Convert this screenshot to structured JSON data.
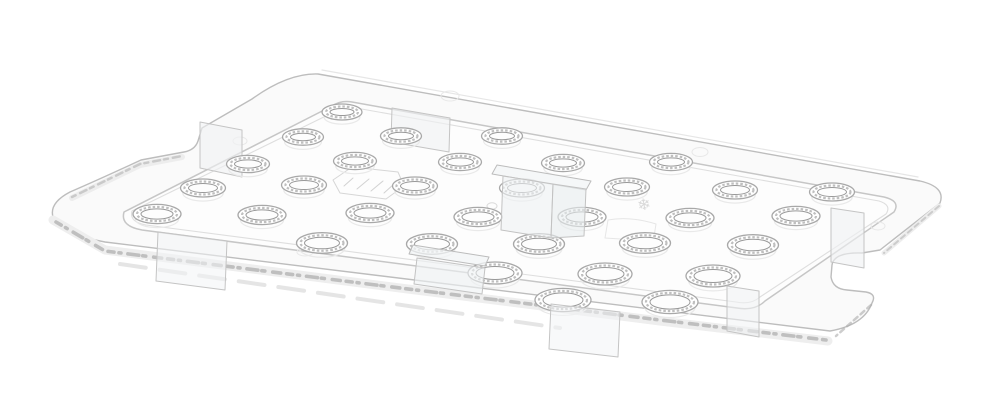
{
  "meta": {
    "background_color": "#ffffff",
    "palette": {
      "plate_fill": "#fafafa",
      "rim_field_fill": "#fdfdfd",
      "outline": "#bdbdbd",
      "rim_line": "#c6c6c6",
      "rim_line_light": "#dedede",
      "hole_ring": "#a8a8a8",
      "hole_texture": "#bfbfbf",
      "hole_inner": "#989898",
      "ghost": "#e9e9e9",
      "sparkle": "#8f8f8f",
      "tab_fill": "rgba(240,242,244,0.6)",
      "tab_stroke": "#bfbfbf"
    }
  },
  "scene": {
    "canvas": {
      "w": 1000,
      "h": 406,
      "bg": "#ffffff"
    },
    "layers": [
      {
        "name": "plate-far-edge-underside",
        "type": "polyline",
        "pts": [
          [
            322,
            70
          ],
          [
            918,
            177
          ]
        ],
        "stroke": "#e6e6e6",
        "w": 1.2
      },
      {
        "name": "plate-body",
        "type": "path",
        "d": "M 318,74 L 920,181 Q 946,187 940,203 L 880,250 L 862,253 Q 834,252 832,265 L 831,277 Q 833,289 847,290 L 866,292 Q 877,294 872,303 Q 864,325 830,331 L 105,242 Q 58,233 53,217 Q 49,203 70,192 Q 100,179 141,160 L 184,152 Q 195,150 198,141 L 202,128 L 252,99 Q 288,73 318,74 Z",
        "fill": "#fafafa",
        "stroke": "#bdbdbd",
        "w": 1.4
      },
      {
        "name": "edge-band-front",
        "type": "polyline",
        "pts": [
          [
            53,
            220
          ],
          [
            105,
            250
          ],
          [
            400,
            288
          ],
          [
            660,
            321
          ],
          [
            828,
            341
          ]
        ],
        "stroke": "#eeeeee",
        "w": 9
      },
      {
        "name": "edge-sparkle-front",
        "type": "polyline",
        "pts": [
          [
            56,
            222
          ],
          [
            105,
            251
          ],
          [
            400,
            288
          ],
          [
            660,
            320
          ],
          [
            826,
            340
          ]
        ],
        "stroke": "#8f8f8f",
        "w": 3.6,
        "dash": "6 5 2 7 11 4 3 8 8 6",
        "opacity": 0.5
      },
      {
        "name": "edge-ghost-line",
        "type": "polyline",
        "pts": [
          [
            120,
            264
          ],
          [
            560,
            328
          ]
        ],
        "stroke": "#e2e2e2",
        "w": 4,
        "dash": "26 14",
        "opacity": 0.9
      },
      {
        "name": "edge-band-left",
        "type": "polyline",
        "pts": [
          [
            72,
            198
          ],
          [
            140,
            165
          ],
          [
            182,
            157
          ]
        ],
        "stroke": "#ededed",
        "w": 6
      },
      {
        "name": "edge-sparkle-left",
        "type": "polyline",
        "pts": [
          [
            72,
            197
          ],
          [
            140,
            164
          ],
          [
            182,
            156
          ]
        ],
        "stroke": "#a8a8a8",
        "w": 2.5,
        "dash": "4 5 7 4",
        "opacity": 0.5
      },
      {
        "name": "edge-band-right",
        "type": "polyline",
        "pts": [
          [
            939,
            206
          ],
          [
            884,
            253
          ]
        ],
        "stroke": "#ededed",
        "w": 5
      },
      {
        "name": "edge-sparkle-right",
        "type": "polyline",
        "pts": [
          [
            939,
            206
          ],
          [
            884,
            253
          ]
        ],
        "stroke": "#ababab",
        "w": 2,
        "dash": "5 4",
        "opacity": 0.5
      },
      {
        "name": "edge-sparkle-corner",
        "type": "polyline",
        "pts": [
          [
            871,
            305
          ],
          [
            836,
            336
          ]
        ],
        "stroke": "#ababab",
        "w": 2.5,
        "dash": "5 4",
        "opacity": 0.6
      },
      {
        "name": "rim-outer",
        "type": "path",
        "d": "M 352,102 L 884,197 Q 901,201 894,212 L 765,301 Q 755,311 737,308 L 142,230 Q 120,226 124,212 L 332,106 Q 341,100 352,102 Z",
        "fill": "#fdfdfd",
        "stroke": "#c6c6c6",
        "w": 1.5
      },
      {
        "name": "rim-inner",
        "type": "path",
        "d": "M 356,108 L 879,201 Q 892,205 886,214 L 760,297 Q 751,305 736,302 L 146,225 Q 129,222 132,211 L 334,112 Q 342,106 356,108 Z",
        "fill": "none",
        "stroke": "#dedede",
        "w": 1.1
      },
      {
        "name": "flange-bump",
        "type": "ellipse",
        "cx": 240,
        "cy": 141,
        "rx": 7,
        "ry": 4,
        "stroke": "#e8e8e8",
        "w": 1,
        "fill": "none"
      },
      {
        "name": "flange-bump",
        "type": "ellipse",
        "cx": 450,
        "cy": 96,
        "rx": 9,
        "ry": 5,
        "stroke": "#e8e8e8",
        "w": 1,
        "fill": "none"
      },
      {
        "name": "flange-bump",
        "type": "ellipse",
        "cx": 700,
        "cy": 152,
        "rx": 8,
        "ry": 4.5,
        "stroke": "#e8e8e8",
        "w": 1,
        "fill": "none"
      },
      {
        "name": "flange-bump",
        "type": "ellipse",
        "cx": 878,
        "cy": 226,
        "rx": 7,
        "ry": 4,
        "stroke": "#e8e8e8",
        "w": 1,
        "fill": "none"
      },
      {
        "name": "flange-bump",
        "type": "ellipse",
        "cx": 305,
        "cy": 252,
        "rx": 8,
        "ry": 4,
        "stroke": "#e8e8e8",
        "w": 1,
        "fill": "none"
      },
      {
        "name": "embossed-marking",
        "type": "path",
        "d": "M 333,180 L 352,167 L 398,172 L 404,186 L 386,199 L 340,193 Z",
        "fill": "none",
        "stroke": "#d6d6d6",
        "w": 1
      },
      {
        "name": "embossed-marking-lines",
        "type": "multiline",
        "segs": [
          [
            [
              344,
              186
            ],
            [
              353,
              178
            ]
          ],
          [
            [
              357,
              189
            ],
            [
              369,
              179
            ]
          ],
          [
            [
              371,
              191
            ],
            [
              383,
              181
            ]
          ],
          [
            [
              384,
              193
            ],
            [
              394,
              184
            ]
          ]
        ],
        "stroke": "#d2d2d2",
        "w": 1
      },
      {
        "name": "snowflake-embossing",
        "type": "glyph",
        "x": 645,
        "y": 210,
        "str": "❄",
        "size": 16,
        "fill": "#d9d9d9",
        "rotate": -10
      },
      {
        "name": "embossed-patch",
        "type": "path",
        "d": "M 608,220 Q 630,216 656,224 L 653,243 Q 630,239 605,238 Z",
        "fill": "none",
        "stroke": "#e6e6e6",
        "w": 1
      },
      {
        "name": "embossed-dot",
        "type": "ellipse",
        "cx": 492,
        "cy": 206,
        "rx": 5,
        "ry": 3.2,
        "stroke": "#dadada",
        "w": 1,
        "fill": "none"
      },
      {
        "name": "clip-tab-left-flange",
        "type": "poly",
        "pts": [
          [
            200,
            122
          ],
          [
            242,
            130
          ],
          [
            242,
            177
          ],
          [
            200,
            168
          ]
        ],
        "fill": "rgba(240,242,244,0.6)",
        "stroke": "#c4c4c4",
        "w": 1
      },
      {
        "name": "clip-tab-top",
        "type": "poly",
        "pts": [
          [
            392,
            108
          ],
          [
            450,
            118
          ],
          [
            449,
            152
          ],
          [
            391,
            142
          ]
        ],
        "fill": "rgba(240,242,244,0.6)",
        "stroke": "#c4c4c4",
        "w": 1
      },
      {
        "name": "drain-holes",
        "type": "holes",
        "colors": {
          "ring": "#a8a8a8",
          "texture": "#bfbfbf",
          "inner": "#989898",
          "ghost": "#e9e9e9",
          "fill": "#ffffff"
        },
        "rows": [
          {
            "rx": 20,
            "ry": 8,
            "cs": [
              [
                342,
                112
              ]
            ]
          },
          {
            "rx": 20.5,
            "ry": 8.2,
            "cs": [
              [
                303,
                137
              ],
              [
                401,
                136
              ],
              [
                502,
                136
              ]
            ]
          },
          {
            "rx": 21.5,
            "ry": 8.6,
            "cs": [
              [
                248,
                164
              ],
              [
                355,
                161
              ],
              [
                460,
                162
              ],
              [
                563,
                163
              ],
              [
                671,
                162
              ]
            ]
          },
          {
            "rx": 22.5,
            "ry": 9,
            "cs": [
              [
                203,
                188
              ],
              [
                304,
                185
              ],
              [
                415,
                186
              ],
              [
                522,
                188
              ],
              [
                627,
                187
              ],
              [
                735,
                190
              ],
              [
                832,
                192
              ]
            ]
          },
          {
            "rx": 24,
            "ry": 9.6,
            "cs": [
              [
                157,
                214
              ],
              [
                262,
                215
              ],
              [
                370,
                213
              ],
              [
                478,
                217
              ],
              [
                582,
                217
              ],
              [
                690,
                218
              ],
              [
                796,
                216
              ]
            ]
          },
          {
            "rx": 25.5,
            "ry": 10.3,
            "cs": [
              [
                322,
                243
              ],
              [
                432,
                244
              ],
              [
                539,
                244
              ],
              [
                645,
                243
              ],
              [
                753,
                245
              ]
            ]
          },
          {
            "rx": 27,
            "ry": 11,
            "cs": [
              [
                495,
                273
              ],
              [
                605,
                274
              ],
              [
                713,
                276
              ]
            ]
          },
          {
            "rx": 28,
            "ry": 11.6,
            "cs": [
              [
                563,
                300
              ],
              [
                670,
                302
              ]
            ]
          }
        ]
      },
      {
        "name": "bracket-center-cap",
        "type": "poly",
        "pts": [
          [
            497,
            165
          ],
          [
            591,
            181
          ],
          [
            586,
            190
          ],
          [
            492,
            174
          ]
        ],
        "fill": "rgba(242,244,246,0.75)",
        "stroke": "#bcbcbc",
        "w": 1
      },
      {
        "name": "bracket-center-panel-left",
        "type": "poly",
        "pts": [
          [
            503,
            176
          ],
          [
            553,
            184
          ],
          [
            551,
            238
          ],
          [
            501,
            230
          ]
        ],
        "fill": "rgba(238,241,243,0.6)",
        "stroke": "#c2c2c2",
        "w": 1
      },
      {
        "name": "bracket-center-panel-right",
        "type": "poly",
        "pts": [
          [
            553,
            184
          ],
          [
            586,
            189
          ],
          [
            584,
            236
          ],
          [
            551,
            238
          ]
        ],
        "fill": "rgba(232,236,239,0.6)",
        "stroke": "#c2c2c2",
        "w": 1
      },
      {
        "name": "bracket-front-cap",
        "type": "poly",
        "pts": [
          [
            413,
            245
          ],
          [
            489,
            257
          ],
          [
            485,
            266
          ],
          [
            409,
            254
          ]
        ],
        "fill": "rgba(242,244,246,0.75)",
        "stroke": "#bcbcbc",
        "w": 1
      },
      {
        "name": "bracket-front-panel",
        "type": "poly",
        "pts": [
          [
            417,
            258
          ],
          [
            485,
            268
          ],
          [
            482,
            294
          ],
          [
            414,
            284
          ]
        ],
        "fill": "rgba(238,241,243,0.6)",
        "stroke": "#c2c2c2",
        "w": 1
      },
      {
        "name": "clip-tab-right",
        "type": "poly",
        "pts": [
          [
            831,
            208
          ],
          [
            864,
            213
          ],
          [
            864,
            268
          ],
          [
            831,
            262
          ]
        ],
        "fill": "rgba(240,242,244,0.6)",
        "stroke": "#c4c4c4",
        "w": 1
      },
      {
        "name": "clip-tab-right-corner",
        "type": "poly",
        "pts": [
          [
            727,
            286
          ],
          [
            759,
            291
          ],
          [
            759,
            337
          ],
          [
            727,
            331
          ]
        ],
        "fill": "rgba(240,242,244,0.55)",
        "stroke": "#c4c4c4",
        "w": 1
      },
      {
        "name": "clip-tab-front",
        "type": "poly",
        "pts": [
          [
            551,
            304
          ],
          [
            620,
            312
          ],
          [
            618,
            357
          ],
          [
            549,
            349
          ]
        ],
        "fill": "rgba(242,244,246,0.55)",
        "stroke": "#c4c4c4",
        "w": 1
      },
      {
        "name": "clip-tab-front-left",
        "type": "poly",
        "pts": [
          [
            158,
            232
          ],
          [
            227,
            241
          ],
          [
            225,
            290
          ],
          [
            156,
            281
          ]
        ],
        "fill": "rgba(242,244,246,0.55)",
        "stroke": "#c4c4c4",
        "w": 1
      }
    ]
  }
}
